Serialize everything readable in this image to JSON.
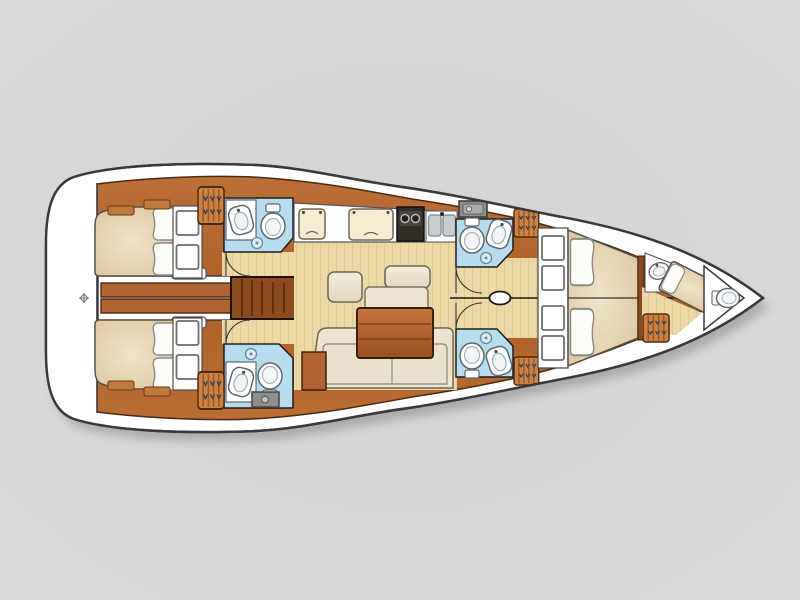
{
  "plan": {
    "label": "Sailing yacht interior deck layout plan, overhead view, bow pointing right",
    "vessel_type": "monohull sailing yacht",
    "orientation": {
      "bow": "right",
      "stern": "left"
    },
    "rooms": [
      {
        "id": "stern-platform",
        "label": "Stern platform / lazarette",
        "fixtures": [
          "helm axis symbol"
        ]
      },
      {
        "id": "aft-cabin-port",
        "label": "Aft double cabin (top/port)",
        "fixtures": [
          "double berth",
          "two pillows",
          "two storage cubbies",
          "two shelves"
        ]
      },
      {
        "id": "aft-cabin-starboard",
        "label": "Aft double cabin (bottom/starboard)",
        "fixtures": [
          "double berth",
          "two pillows",
          "two storage cubbies",
          "two shelves"
        ]
      },
      {
        "id": "aft-head-port",
        "label": "Aft head (top/port)",
        "fixtures": [
          "washbasin counter",
          "toilet",
          "shower drain",
          "hanging locker",
          "door"
        ]
      },
      {
        "id": "aft-head-starboard",
        "label": "Aft head (bottom/starboard)",
        "fixtures": [
          "washbasin counter",
          "toilet",
          "shower drain",
          "hanging locker",
          "appliance box",
          "door"
        ]
      },
      {
        "id": "companionway",
        "label": "Companionway walkway and steps",
        "fixtures": [
          "twin planks",
          "step block",
          "two side steps"
        ]
      },
      {
        "id": "galley",
        "label": "Galley (top of saloon)",
        "fixtures": [
          "fridge lid",
          "fridge lid wide",
          "two-burner stove",
          "double sink"
        ]
      },
      {
        "id": "saloon",
        "label": "Saloon",
        "fixtures": [
          "dining table",
          "two seats",
          "bench seat",
          "L-sofa",
          "side cabinet"
        ]
      },
      {
        "id": "mast",
        "label": "Mast post on centerline"
      },
      {
        "id": "fwd-head-port",
        "label": "Forward head (top/port)",
        "fixtures": [
          "toilet",
          "washbasin",
          "shower drain",
          "hanging locker",
          "oven unit",
          "door"
        ]
      },
      {
        "id": "fwd-head-starboard",
        "label": "Forward head (bottom/starboard)",
        "fixtures": [
          "toilet",
          "washbasin",
          "shower drain",
          "hanging locker",
          "door"
        ]
      },
      {
        "id": "forward-cabin",
        "label": "Forward owner cabin",
        "fixtures": [
          "V-berth double",
          "two pillows",
          "four storage cubbies"
        ]
      },
      {
        "id": "bow-cabin",
        "label": "Bow crew cabin",
        "fixtures": [
          "angled single berth",
          "washbasin",
          "hanging locker"
        ]
      },
      {
        "id": "bow-head",
        "label": "Forepeak compartment",
        "fixtures": [
          "toilet"
        ]
      }
    ]
  },
  "palette": {
    "background": "#d6d6d6",
    "hull_fill": "#ffffff",
    "hull_outline": "#3a3a3a",
    "wood": "#b0642f",
    "wood_dark": "#8d4a1e",
    "wood_line": "#4a2a10",
    "floor": "#ecd8a4",
    "bed": "#e7d6b6",
    "cushion": "#ece4d0",
    "cushion_light": "#f6ecd2",
    "pillow": "#fcfbf6",
    "bath": "#b6dcee",
    "fixture": "#ffffff",
    "fixture_line": "#5f6a70",
    "locker": "#cd8244",
    "locker_stripe": "#9c5a22",
    "locker_marks": "#33425c",
    "steel": "#c9ced2",
    "stove": "#332d28",
    "appliance": "#8e8e8e",
    "outline": "#2c2c2c"
  }
}
